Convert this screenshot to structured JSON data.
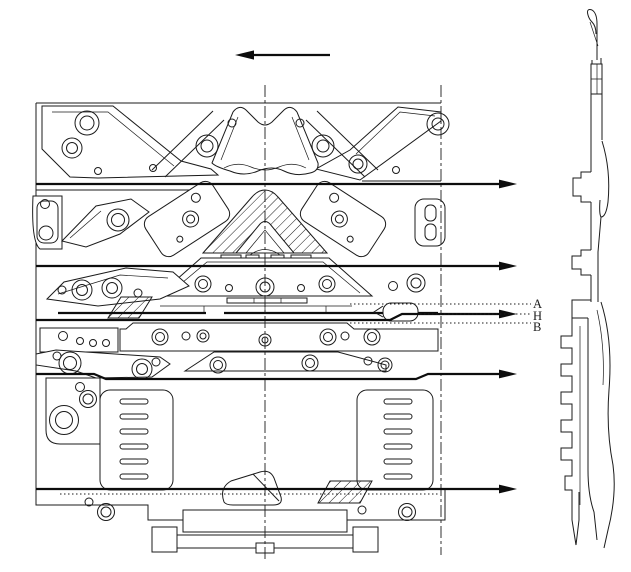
{
  "drawing": {
    "background": "#ffffff",
    "stroke_color": "#1b1b1b",
    "labels": {
      "a": "A",
      "h": "H",
      "b": "B"
    },
    "carriage_arrow_direction": "left",
    "needle_path_arrow_count": 5
  }
}
